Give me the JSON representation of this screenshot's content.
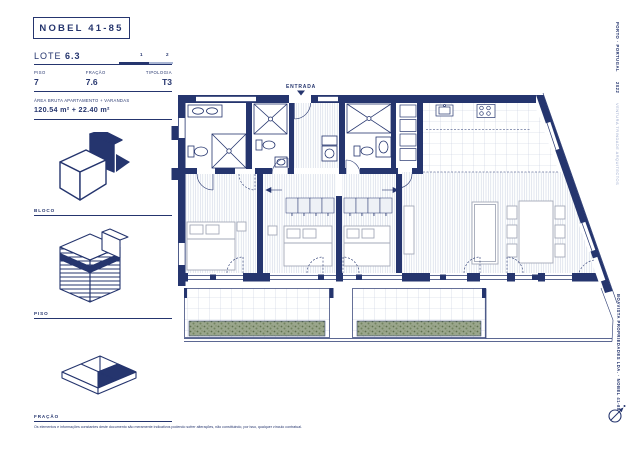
{
  "header": {
    "title": "NOBEL 41-85"
  },
  "sidebar": {
    "lote_label": "LOTE",
    "lote_value": "6.3",
    "pagination": {
      "page1": "1",
      "page2": "2"
    },
    "fields": [
      {
        "label": "PISO",
        "value": "7"
      },
      {
        "label": "FRAÇÃO",
        "value": "7.6"
      },
      {
        "label": "TIPOLOGIA",
        "value": "T3"
      }
    ],
    "area_label": "ÁREA BRUTA APARTAMENTO + VARANDAS",
    "area_value": "120.54 m² + 22.40 m²",
    "sections": [
      {
        "label": "BLOCO",
        "icon": "block-axonometric"
      },
      {
        "label": "PISO",
        "icon": "floor-stack-axonometric"
      },
      {
        "label": "FRAÇÃO",
        "icon": "unit-slab-axonometric"
      }
    ],
    "disclaimer": "Os elementos e informações constantes deste documento são meramente indicativos podendo sofrer alterações, não constituindo, por isso, qualquer vínculo contratual."
  },
  "plan": {
    "entrance_label": "ENTRADA"
  },
  "margins": {
    "top_right_location": "PORTO · PORTUGAL",
    "top_right_year": "2022",
    "top_right_credit": "VENTURA TRINDADE ARQUITECTOS",
    "bottom_right_credit": "BOAVISTA PROPRIEDADES LDA. · NOBEL 41-85"
  },
  "icons": {
    "compass": "north-arrow",
    "entrance_marker": "triangle-down"
  },
  "colors": {
    "navy": "#25356e",
    "light_blue": "#aab6d4",
    "hatch": "#cdd4e3",
    "planter_green": "#72835f",
    "background": "#ffffff"
  }
}
